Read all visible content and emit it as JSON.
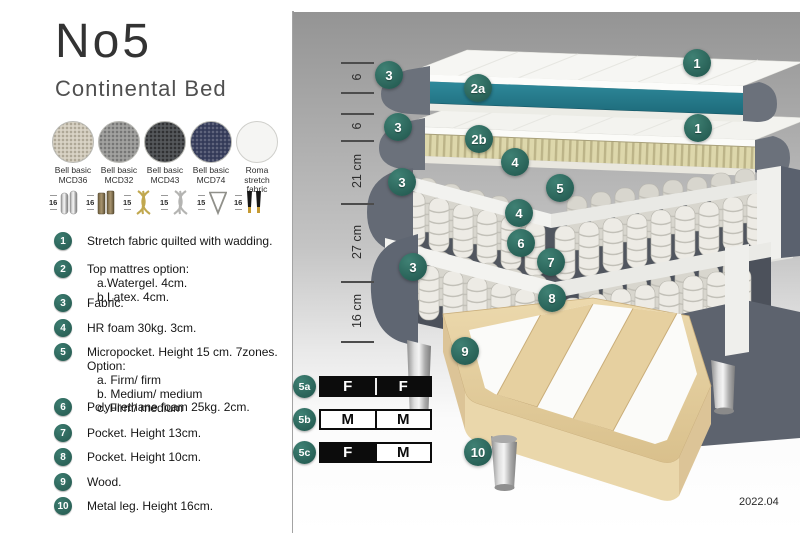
{
  "header": {
    "title": "No5",
    "subtitle": "Continental Bed"
  },
  "fabric_options": [
    {
      "line1": "Bell basic",
      "line2": "MCD36",
      "swatch": "light-beige-weave"
    },
    {
      "line1": "Bell basic",
      "line2": "MCD32",
      "swatch": "gray-weave"
    },
    {
      "line1": "Bell basic",
      "line2": "MCD43",
      "swatch": "dark-gray-weave"
    },
    {
      "line1": "Bell basic",
      "line2": "MCD74",
      "swatch": "navy-weave"
    },
    {
      "line1": "Roma",
      "line2": "stretch fabric",
      "swatch": "plain-white"
    }
  ],
  "leg_options": [
    {
      "height": "16",
      "style": "cylinder-silver"
    },
    {
      "height": "16",
      "style": "block-bronze"
    },
    {
      "height": "15",
      "style": "twisted-gold"
    },
    {
      "height": "15",
      "style": "twisted-silver"
    },
    {
      "height": "15",
      "style": "hairpin-metal"
    },
    {
      "height": "16",
      "style": "black-gold-tip"
    }
  ],
  "features": [
    {
      "num": "1",
      "text": "Stretch fabric quilted with wadding."
    },
    {
      "num": "2",
      "text": "Top mattres option:",
      "subs": [
        "a.Watergel. 4cm.",
        "b.Latex. 4cm."
      ]
    },
    {
      "num": "3",
      "text": "Fabric."
    },
    {
      "num": "4",
      "text": "HR foam 30kg. 3cm."
    },
    {
      "num": "5",
      "text": "Micropocket. Height 15 cm. 7zones. Option:",
      "subs": [
        "a. Firm/ firm",
        "b. Medium/ medium",
        "c. Firm/ medium"
      ]
    },
    {
      "num": "6",
      "text": "Polyurethane foam 25kg. 2cm."
    },
    {
      "num": "7",
      "text": "Pocket. Height 13cm."
    },
    {
      "num": "8",
      "text": "Pocket. Height 10cm."
    },
    {
      "num": "9",
      "text": "Wood."
    },
    {
      "num": "10",
      "text": "Metal leg. Height 16cm."
    }
  ],
  "diagram": {
    "badges": [
      "1",
      "3",
      "2a",
      "1",
      "3",
      "2b",
      "4",
      "3",
      "5",
      "4",
      "6",
      "7",
      "3",
      "8",
      "9",
      "10"
    ],
    "dimensions": [
      "6",
      "6",
      "21 cm",
      "27 cm",
      "16 cm"
    ],
    "firmness_rows": [
      {
        "id": "5a",
        "cells": [
          {
            "letter": "F",
            "fill": "black"
          },
          {
            "letter": "F",
            "fill": "black"
          }
        ]
      },
      {
        "id": "5b",
        "cells": [
          {
            "letter": "M",
            "fill": "white"
          },
          {
            "letter": "M",
            "fill": "white"
          }
        ]
      },
      {
        "id": "5c",
        "cells": [
          {
            "letter": "F",
            "fill": "black"
          },
          {
            "letter": "M",
            "fill": "white"
          }
        ]
      }
    ],
    "version": "2022.04"
  },
  "colors": {
    "badge_teal": "#2d6a62",
    "core_teal": "#2a7f90",
    "latex_beige": "#d9d3a6",
    "fabric_gray": "#666c77",
    "wood": "#e4cfa0"
  }
}
